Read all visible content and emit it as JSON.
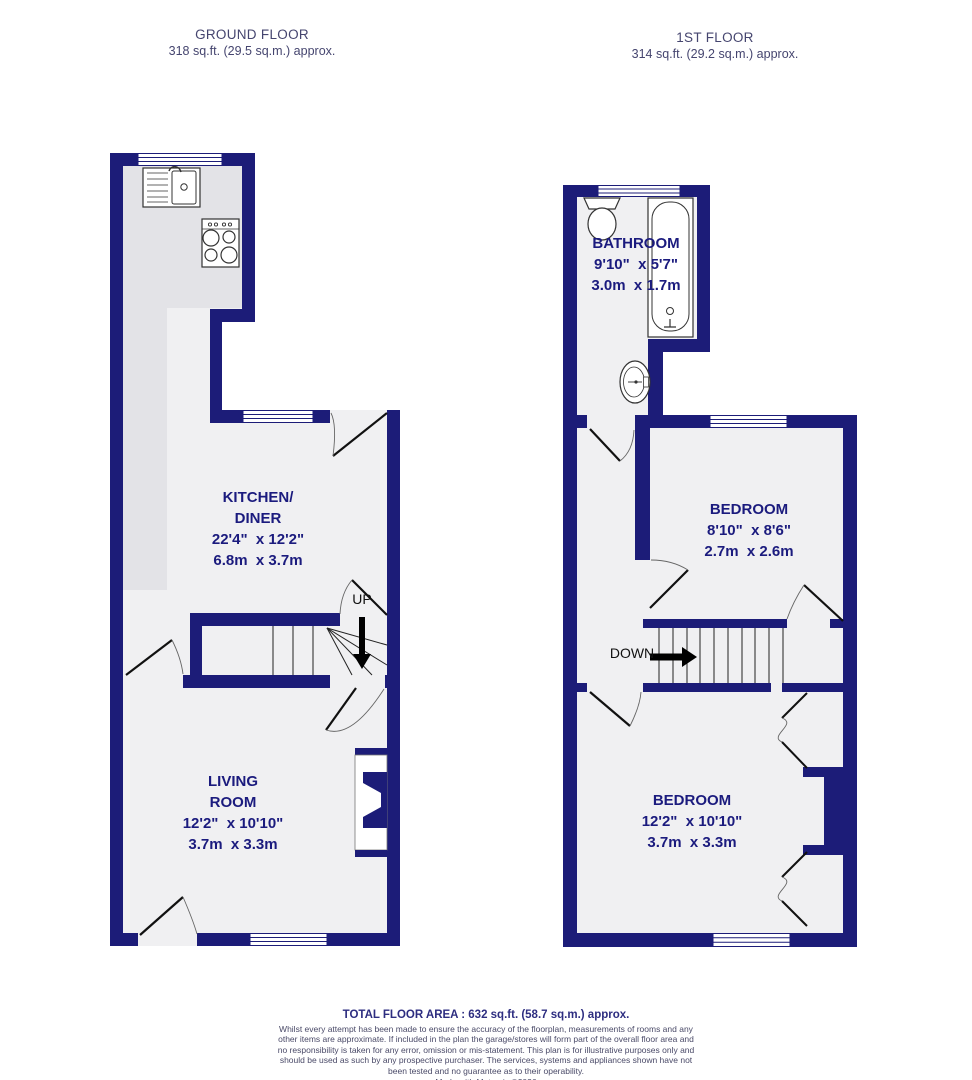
{
  "colors": {
    "wall": "#1c1c78",
    "room_label_text": "#1b1b7e",
    "floor_fill": "#f0f0f2",
    "kitchen_counter_fill": "#e3e3e7",
    "header_text": "#45456f",
    "footer_text": "#4a4a68",
    "arrow": "#000000"
  },
  "headers": {
    "ground": {
      "title": "GROUND FLOOR",
      "area": "318 sq.ft. (29.5 sq.m.) approx."
    },
    "first": {
      "title": "1ST FLOOR",
      "area": "314 sq.ft. (29.2 sq.m.) approx."
    }
  },
  "rooms": {
    "kitchen": {
      "name_line1": "KITCHEN/",
      "name_line2": "DINER",
      "size_imperial": "22'4\"  x 12'2\"",
      "size_metric": "6.8m  x 3.7m"
    },
    "living": {
      "name_line1": "LIVING",
      "name_line2": "ROOM",
      "size_imperial": "12'2\"  x 10'10\"",
      "size_metric": "3.7m  x 3.3m"
    },
    "bathroom": {
      "name": "BATHROOM",
      "size_imperial": "9'10\"  x 5'7\"",
      "size_metric": "3.0m  x 1.7m"
    },
    "bedroom1": {
      "name": "BEDROOM",
      "size_imperial": "8'10\"  x 8'6\"",
      "size_metric": "2.7m  x 2.6m"
    },
    "bedroom2": {
      "name": "BEDROOM",
      "size_imperial": "12'2\"  x 10'10\"",
      "size_metric": "3.7m  x 3.3m"
    }
  },
  "stairs": {
    "up_label": "UP",
    "down_label": "DOWN"
  },
  "footer": {
    "total_area": "TOTAL FLOOR AREA : 632 sq.ft. (58.7 sq.m.) approx.",
    "disclaimer": "Whilst every attempt has been made to ensure the accuracy of the floorplan, measurements of rooms and any other items are approximate. If included in the plan the garage/stores will form part of the overall floor area and no responsibility is taken for any error, omission or mis-statement. This plan is for illustrative purposes only and should be used as such by any prospective purchaser. The services, systems and appliances shown have not been tested and no guarantee as to their operability.",
    "credit": "Made with Metropix ©2026"
  }
}
